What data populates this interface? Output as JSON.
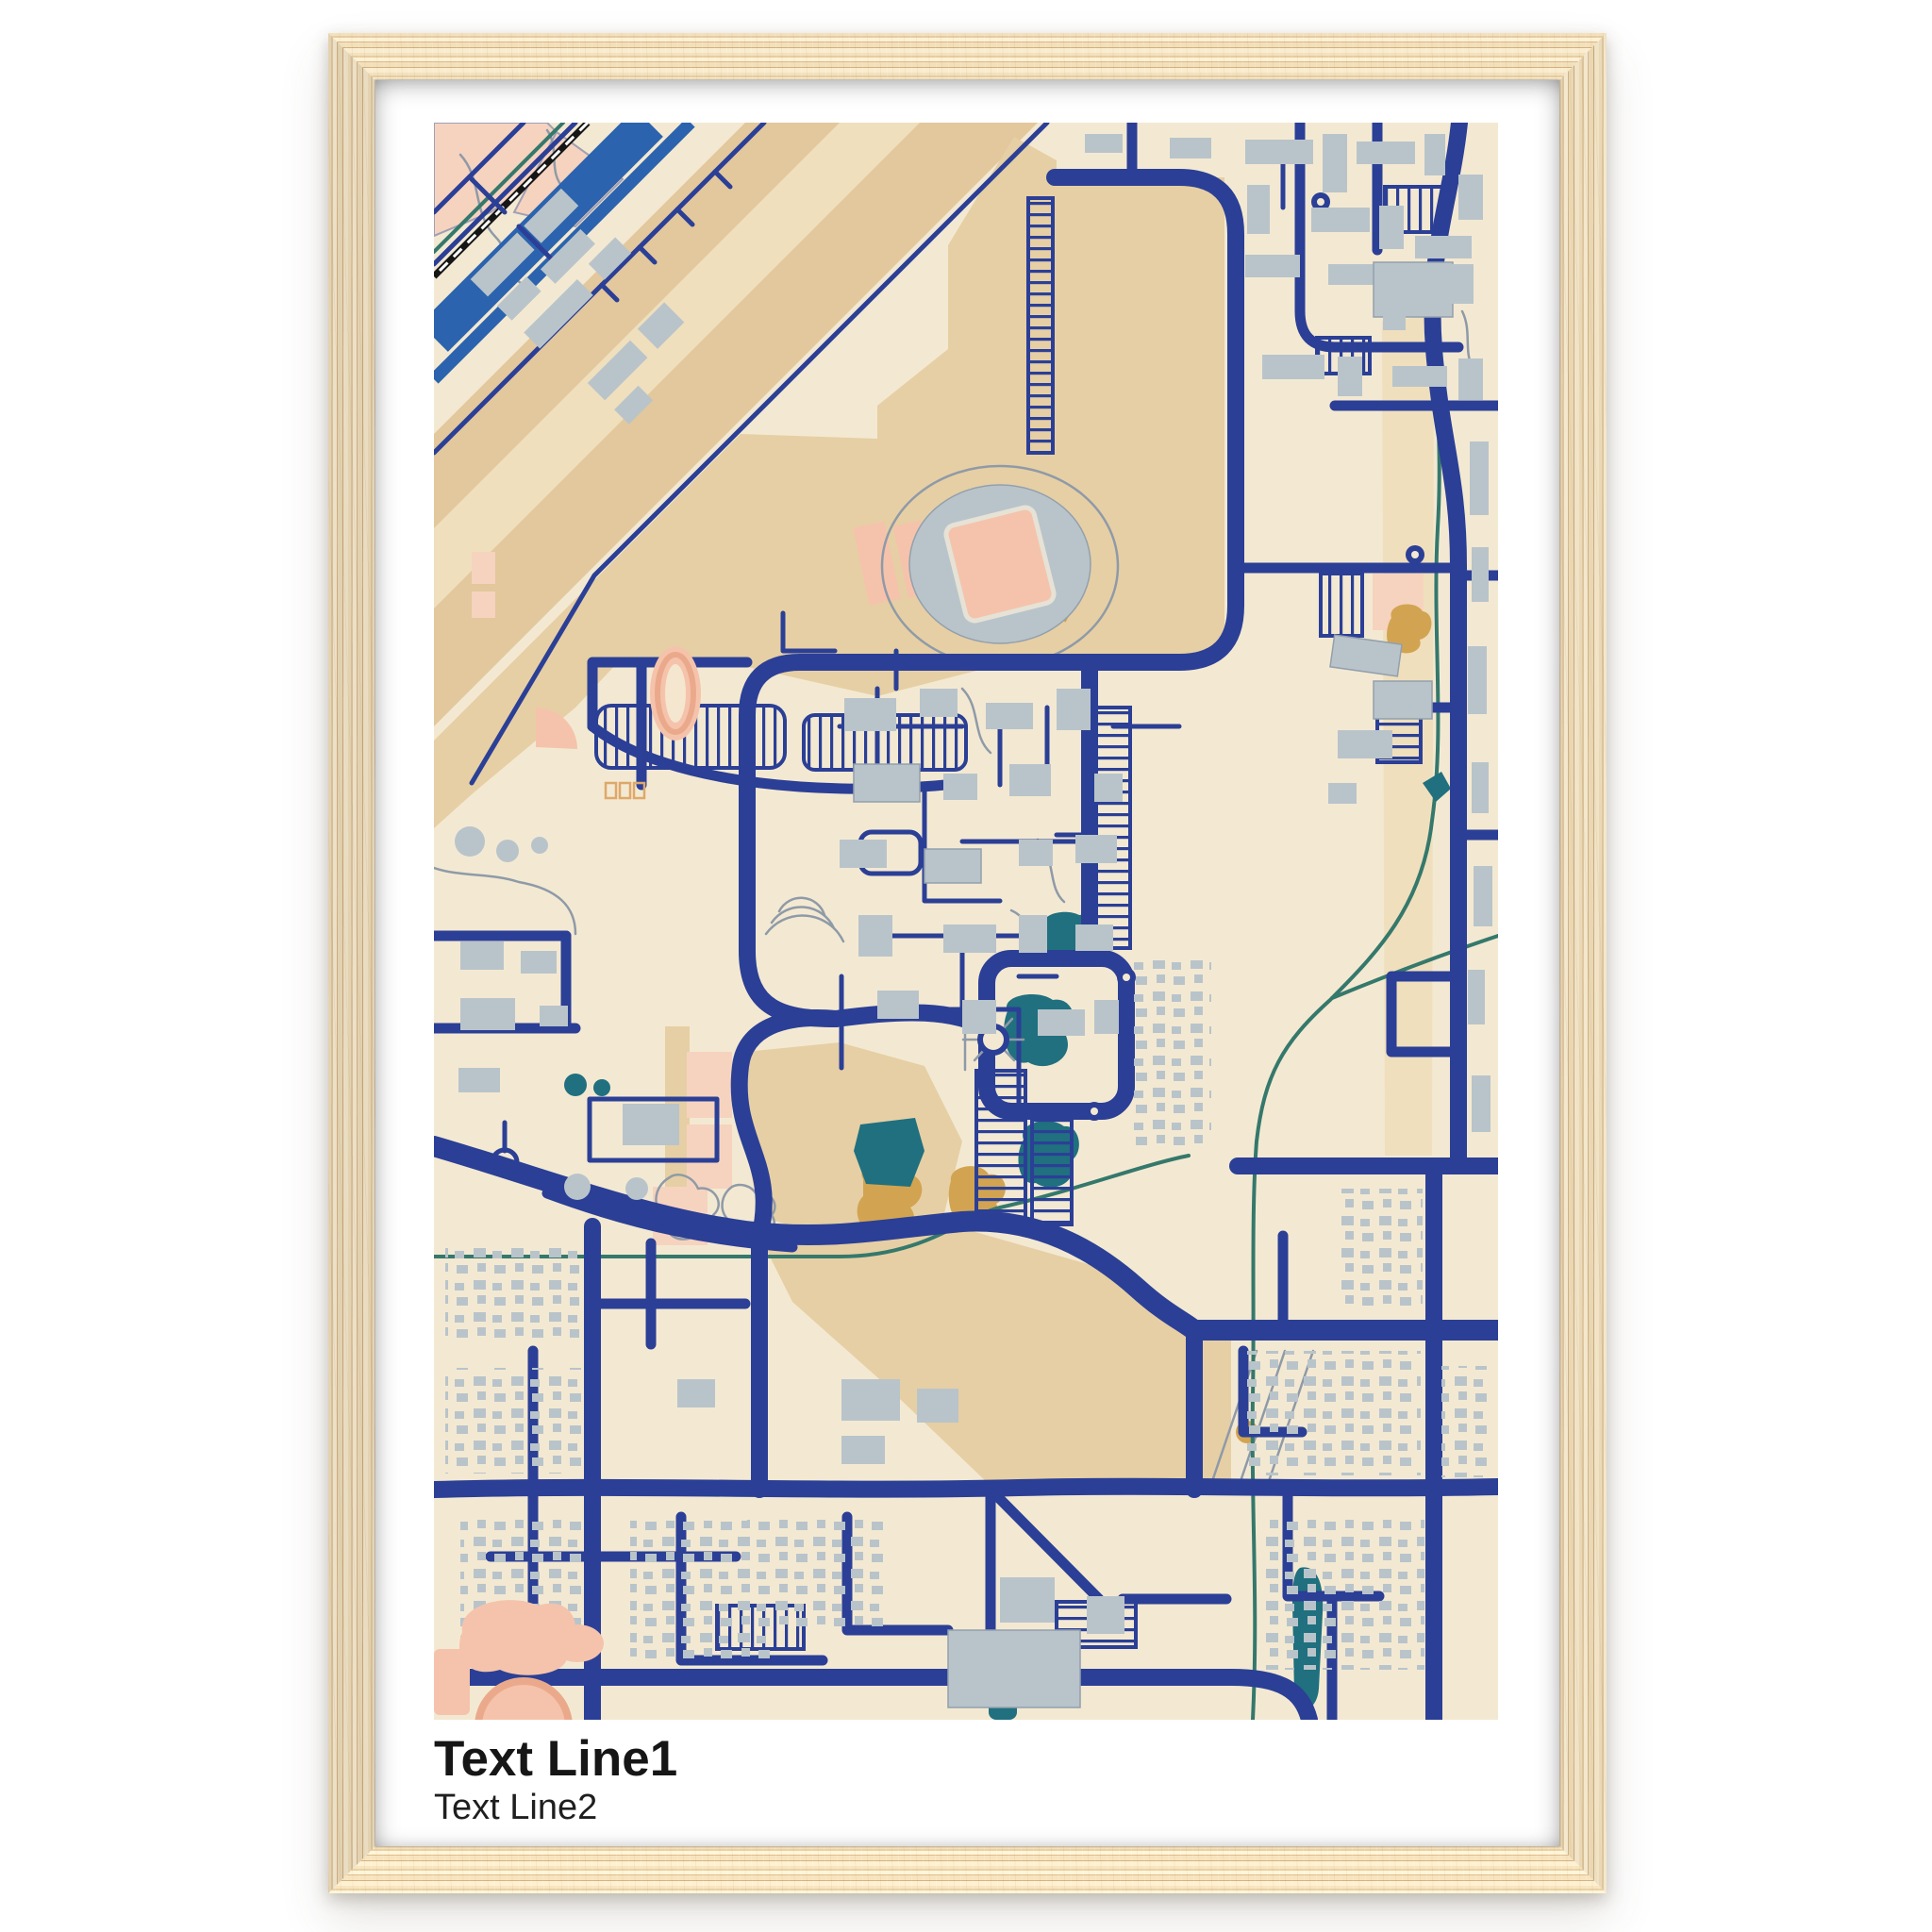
{
  "poster": {
    "title_line1": "Text Line1",
    "title_line2": "Text Line2"
  },
  "palette": {
    "cream": "#f3e9d2",
    "tan": "#e6cfa4",
    "tan-dark": "#e2c89c",
    "tan-light": "#efdfbd",
    "salmon": "#f5c3ab",
    "salmon-light": "#f6d3bf",
    "salmon-dark": "#eba98c",
    "mustard": "#d2a451",
    "bld": "#b9c4ca",
    "bld-line": "#93a0ad",
    "path-gray": "#8f9aa8",
    "navy": "#2b3f96",
    "motorway": "#2b63ae",
    "pond": "#20707f",
    "river": "#35786c",
    "rail": "#161616",
    "mat": "#ffffff",
    "wood-base": "#ecd9b8",
    "wood-dark": "#cfae82",
    "wood-mid": "#dec49c",
    "wood-light": "#f6ecd7",
    "text": "#161616"
  }
}
